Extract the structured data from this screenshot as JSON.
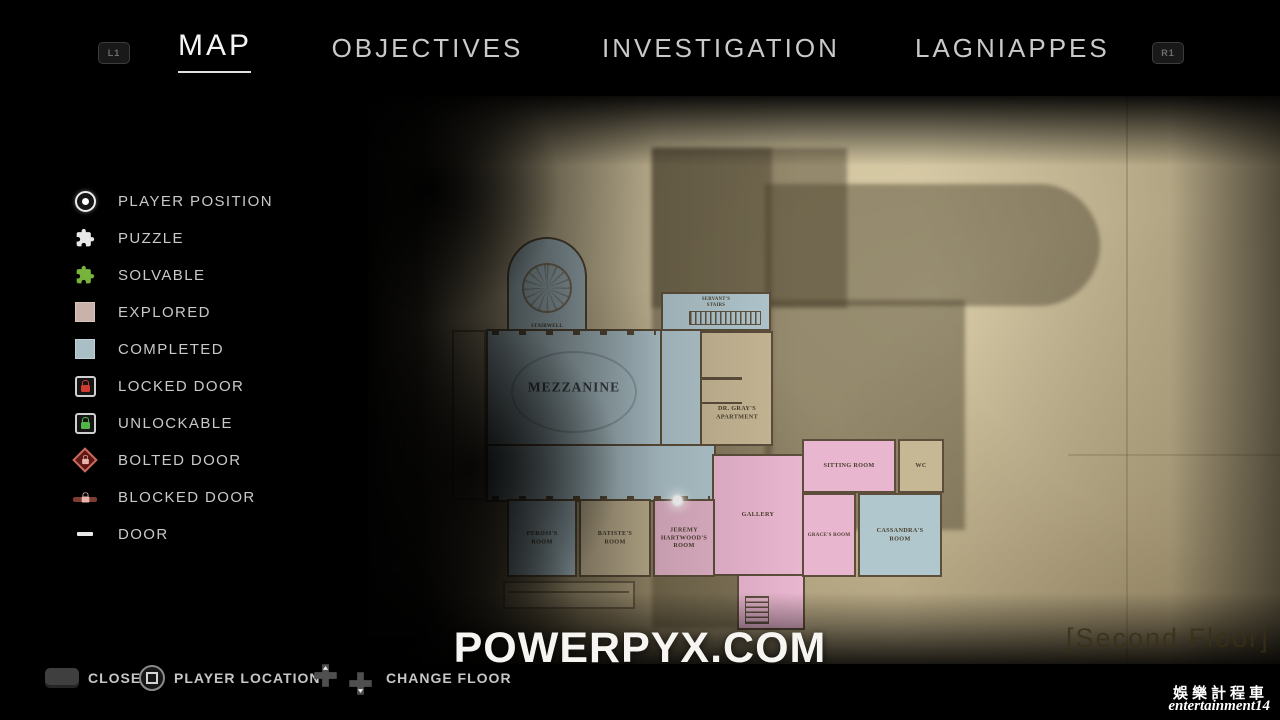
{
  "nav": {
    "l1": "L1",
    "r1": "R1",
    "tabs": [
      {
        "label": "MAP",
        "active": true
      },
      {
        "label": "OBJECTIVES",
        "active": false
      },
      {
        "label": "INVESTIGATION",
        "active": false
      },
      {
        "label": "LAGNIAPPES",
        "active": false
      }
    ]
  },
  "legend": {
    "items": [
      {
        "name": "player-position",
        "label": "PLAYER POSITION"
      },
      {
        "name": "puzzle",
        "label": "PUZZLE"
      },
      {
        "name": "solvable",
        "label": "SOLVABLE"
      },
      {
        "name": "explored",
        "label": "EXPLORED"
      },
      {
        "name": "completed",
        "label": "COMPLETED"
      },
      {
        "name": "locked-door",
        "label": "LOCKED DOOR"
      },
      {
        "name": "unlockable",
        "label": "UNLOCKABLE"
      },
      {
        "name": "bolted-door",
        "label": "BOLTED DOOR"
      },
      {
        "name": "blocked-door",
        "label": "BLOCKED DOOR"
      },
      {
        "name": "door",
        "label": "DOOR"
      }
    ]
  },
  "map": {
    "floor_label": "[Second Floor]",
    "rooms": [
      {
        "label": "STAIRWELL",
        "state": "completed"
      },
      {
        "label": "SERVANT'S\nSTAIRS",
        "state": "completed"
      },
      {
        "label": "MEZZANINE",
        "state": "completed"
      },
      {
        "label": "DR. GRAY'S\nAPARTMENT",
        "state": "explored"
      },
      {
        "label": "SITTING ROOM",
        "state": "explored"
      },
      {
        "label": "WC",
        "state": "explored"
      },
      {
        "label": "GALLERY",
        "state": "explored"
      },
      {
        "label": "PEROSI'S\nROOM",
        "state": "completed"
      },
      {
        "label": "BATISTE'S\nROOM",
        "state": "explored"
      },
      {
        "label": "JEREMY\nHARTWOOD'S\nROOM",
        "state": "explored"
      },
      {
        "label": "GRACE'S ROOM",
        "state": "explored"
      },
      {
        "label": "CASSANDRA'S\nROOM",
        "state": "completed"
      }
    ]
  },
  "footer": {
    "close": "CLOSE",
    "player_location": "PLAYER LOCATION",
    "change_floor": "CHANGE FLOOR"
  },
  "watermarks": {
    "site": "POWERPYX.COM",
    "cn_name": "娛樂計程車",
    "cn_handle": "entertainment14"
  },
  "colors": {
    "paper": "#cfc19c",
    "room_blue": "#b1c7ce",
    "room_pink": "#e9b6cf",
    "room_pink_muted": "#e2b3c7",
    "room_tan": "#c6b795",
    "wall": "#5c4e3a",
    "explored": "#c8b2a9",
    "completed": "#a9bec5",
    "solvable_green": "#77b43d",
    "puzzle_white": "#e8e8e8",
    "locked_red": "#cf3b30",
    "unlock_green": "#52b548",
    "bolt_red": "#c96a5e",
    "accent_underline": "#e0e0e0"
  }
}
